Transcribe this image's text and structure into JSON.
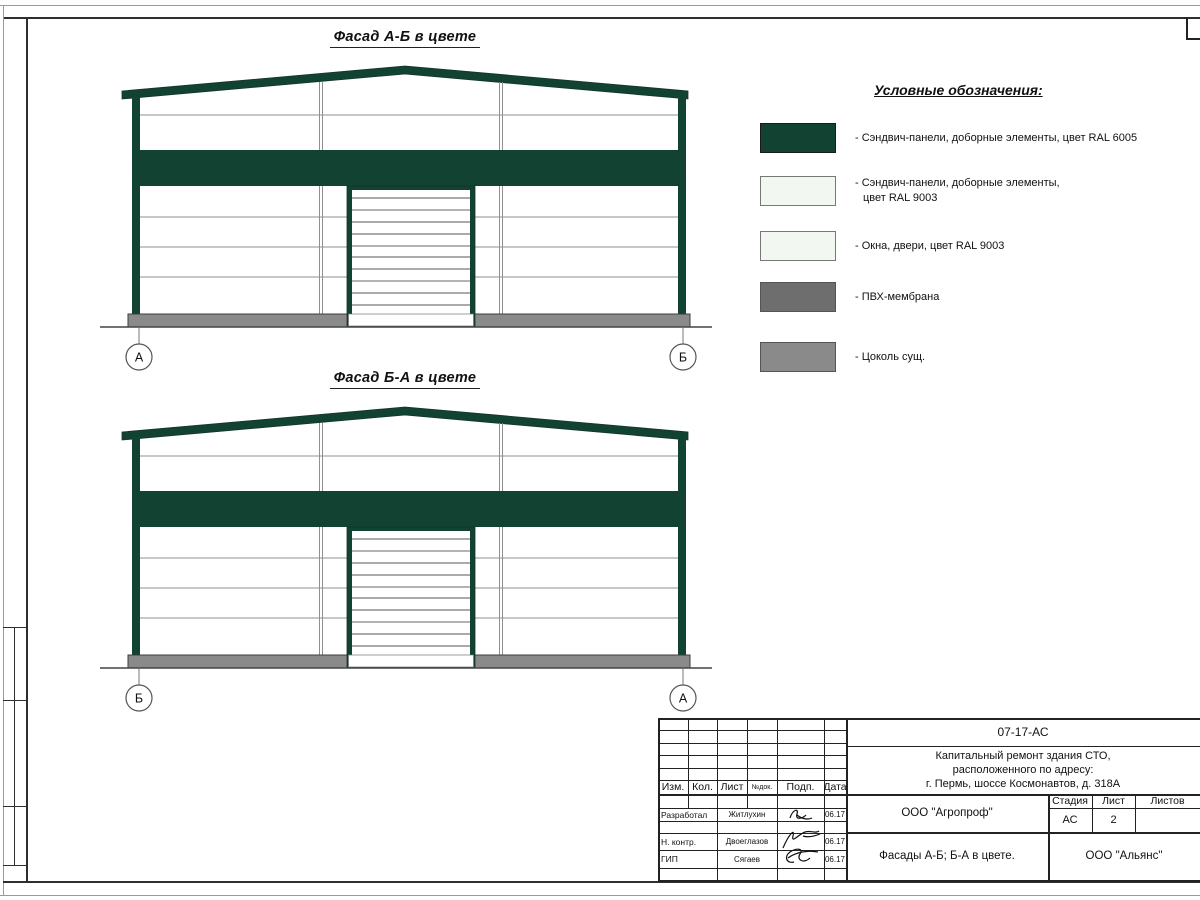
{
  "colors": {
    "ral6005": "#114232",
    "ral9003": "#f2f7f2",
    "pvc_membrane": "#6e6e6e",
    "plinth": "#8a8a8a"
  },
  "facades": [
    {
      "title": "Фасад А-Б в цвете",
      "axis_left": "А",
      "axis_right": "Б"
    },
    {
      "title": "Фасад Б-А в цвете",
      "axis_left": "Б",
      "axis_right": "А"
    }
  ],
  "legend": {
    "title": "Условные обозначения:",
    "items": [
      {
        "color": "#114232",
        "line1": "- Сэндвич-панели, доборные элементы,  цвет RAL 6005",
        "line2": ""
      },
      {
        "color": "#f2f7f2",
        "line1": "- Сэндвич-панели, доборные элементы,",
        "line2": "цвет RAL 9003"
      },
      {
        "color": "#f2f7f2",
        "line1": "- Окна, двери, цвет RAL 9003",
        "line2": ""
      },
      {
        "color": "#6e6e6e",
        "line1": "- ПВХ-мембрана",
        "line2": ""
      },
      {
        "color": "#8a8a8a",
        "line1": "- Цоколь сущ.",
        "line2": ""
      }
    ]
  },
  "title_block": {
    "doc_code": "07-17-АС",
    "project_line1": "Капитальный ремонт здания СТО,",
    "project_line2": "расположенного по адресу:",
    "project_line3": "г. Пермь, шоссе Космонавтов, д. 318А",
    "col_izm": "Изм.",
    "col_kol": "Кол.",
    "col_list": "Лист",
    "col_ndok": "№док.",
    "col_podp": "Подп.",
    "col_data": "Дата",
    "rows": [
      {
        "role": "Разработал",
        "name": "Житлухин",
        "date": "06.17"
      },
      {
        "role": "Н. контр.",
        "name": "Двоеглазов",
        "date": "06.17"
      },
      {
        "role": "ГИП",
        "name": "Сягаев",
        "date": "06.17"
      }
    ],
    "company": "ООО \"Агропроф\"",
    "stage_label": "Стадия",
    "sheet_label": "Лист",
    "sheets_label": "Листов",
    "stage": "АС",
    "sheet_no": "2",
    "drawing_title": "Фасады А-Б; Б-А в цвете.",
    "org": "ООО \"Альянс\""
  }
}
